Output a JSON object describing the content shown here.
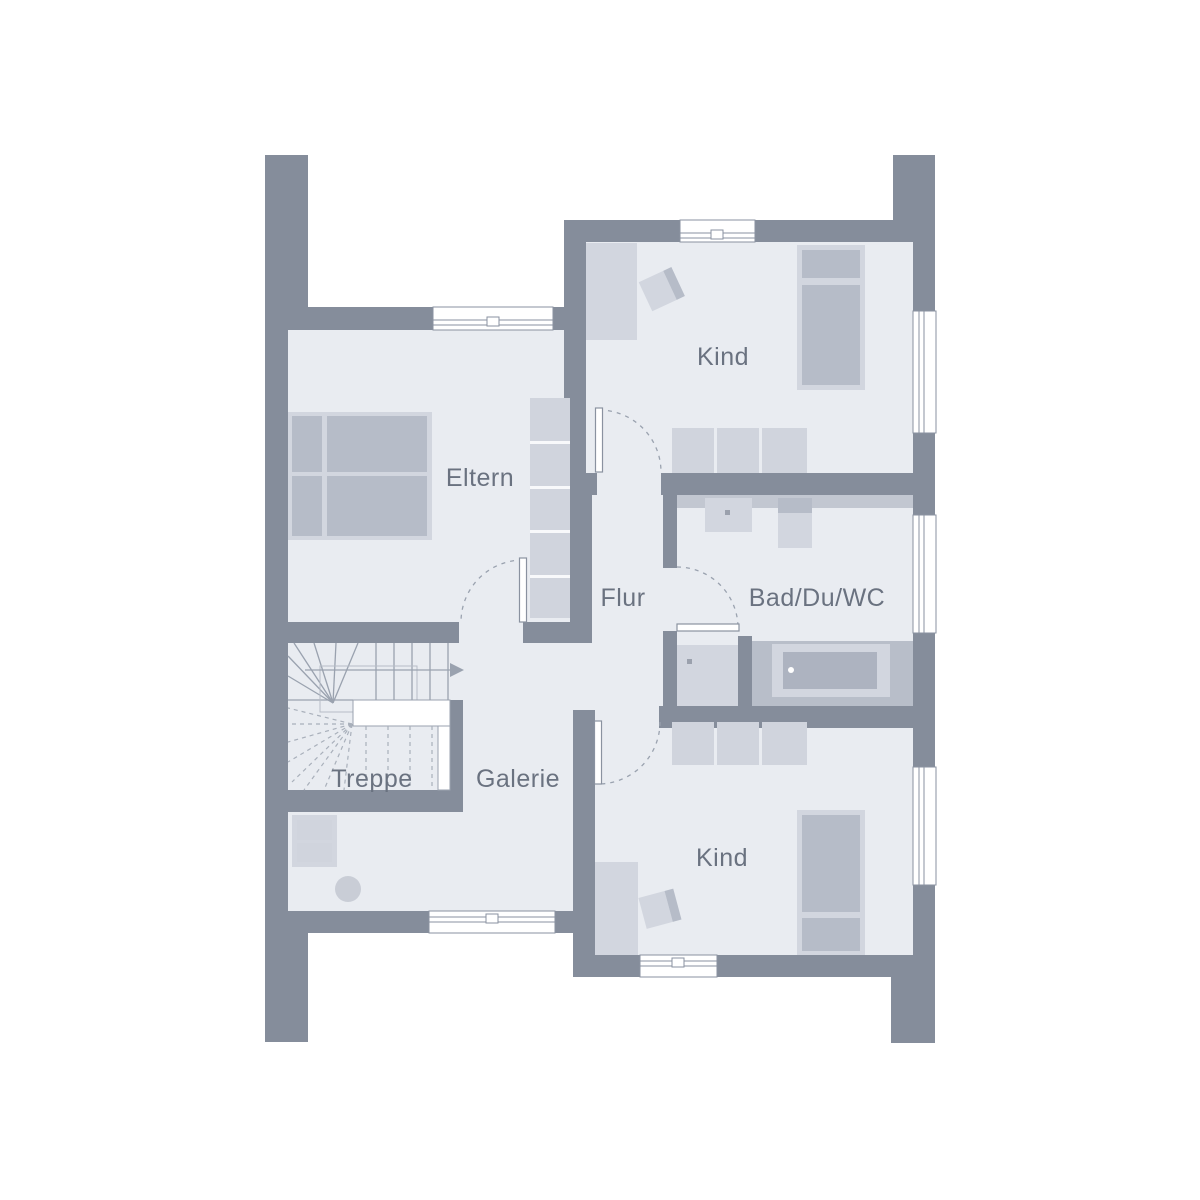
{
  "rooms": {
    "eltern": {
      "label": "Eltern"
    },
    "kind_top": {
      "label": "Kind"
    },
    "flur": {
      "label": "Flur"
    },
    "bad": {
      "label": "Bad/Du/WC"
    },
    "treppe": {
      "label": "Treppe"
    },
    "galerie": {
      "label": "Galerie"
    },
    "kind_bottom": {
      "label": "Kind"
    }
  },
  "colors": {
    "background": "#ffffff",
    "wall": "#858d9b",
    "floor": "#e9ecf1",
    "furniture_light": "#d2d6df",
    "furniture_mid": "#b6bcc8",
    "wardrobe_cell": "#d0d4dd",
    "counter": "#c2c7d1",
    "tub_backing": "#b8bec9",
    "tub_inner": "#adb3c0",
    "label_text": "#6a7280",
    "line": "#9aa2af",
    "window_border": "#8a92a0"
  }
}
